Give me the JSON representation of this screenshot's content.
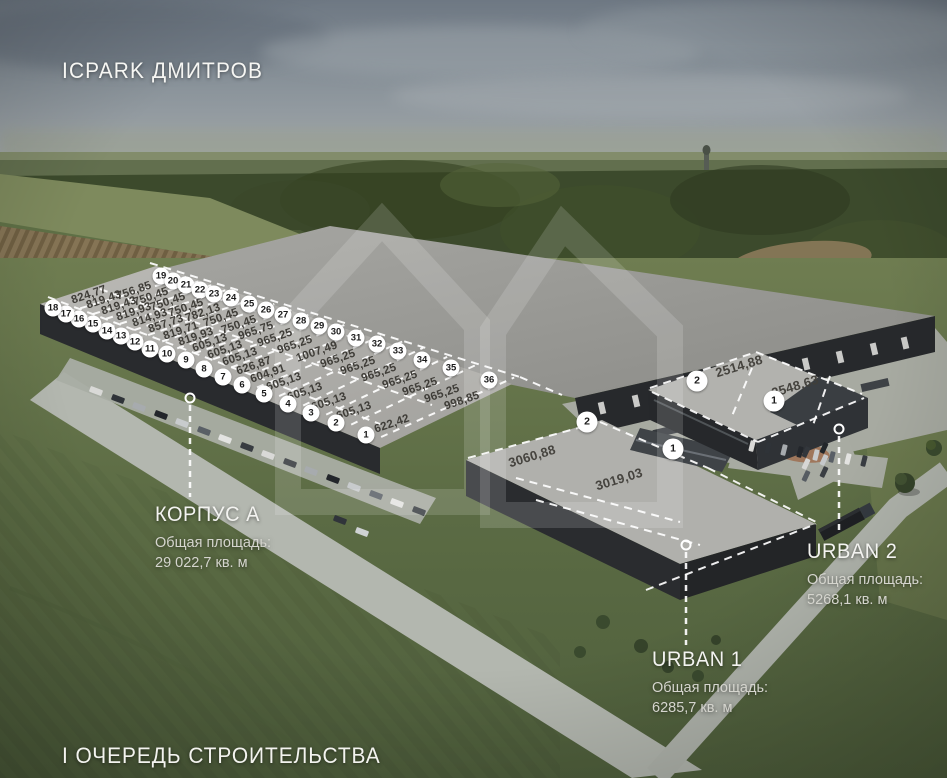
{
  "title": "ICPARK ДМИТРОВ",
  "phase": "I ОЧЕРЕДЬ СТРОИТЕЛЬСТВА",
  "blocks": {
    "korpus_a": {
      "name": "КОРПУС А",
      "area_caption": "Общая площадь:",
      "area_value": "29 022,7 кв. м"
    },
    "urban_1": {
      "name": "URBAN 1",
      "area_caption": "Общая площадь:",
      "area_value": "6285,7 кв. м"
    },
    "urban_2": {
      "name": "URBAN 2",
      "area_caption": "Общая площадь:",
      "area_value": "5268,1 кв. м"
    }
  },
  "korpus_a_units": [
    {
      "n": 1,
      "mx": 366,
      "my": 435,
      "lx": 392,
      "ly": 424,
      "area": "622,42"
    },
    {
      "n": 2,
      "mx": 336,
      "my": 423,
      "lx": 354,
      "ly": 411,
      "area": "605,13"
    },
    {
      "n": 3,
      "mx": 311,
      "my": 413,
      "lx": 329,
      "ly": 402,
      "area": "605,13"
    },
    {
      "n": 4,
      "mx": 288,
      "my": 404,
      "lx": 305,
      "ly": 392,
      "area": "605,13"
    },
    {
      "n": 5,
      "mx": 264,
      "my": 394,
      "lx": 284,
      "ly": 382,
      "area": "605,13"
    },
    {
      "n": 6,
      "mx": 242,
      "my": 385,
      "lx": 268,
      "ly": 374,
      "area": "604,91"
    },
    {
      "n": 7,
      "mx": 223,
      "my": 377,
      "lx": 254,
      "ly": 366,
      "area": "626,87"
    },
    {
      "n": 8,
      "mx": 204,
      "my": 369,
      "lx": 240,
      "ly": 357,
      "area": "605,13"
    },
    {
      "n": 9,
      "mx": 186,
      "my": 360,
      "lx": 225,
      "ly": 350,
      "area": "605,13"
    },
    {
      "n": 10,
      "mx": 167,
      "my": 354,
      "lx": 210,
      "ly": 343,
      "area": "605,13"
    },
    {
      "n": 11,
      "mx": 150,
      "my": 349,
      "lx": 196,
      "ly": 337,
      "area": "819,93"
    },
    {
      "n": 12,
      "mx": 135,
      "my": 342,
      "lx": 181,
      "ly": 331,
      "area": "819,71"
    },
    {
      "n": 13,
      "mx": 121,
      "my": 336,
      "lx": 166,
      "ly": 324,
      "area": "857,73"
    },
    {
      "n": 14,
      "mx": 107,
      "my": 331,
      "lx": 150,
      "ly": 318,
      "area": "814,93"
    },
    {
      "n": 15,
      "mx": 93,
      "my": 324,
      "lx": 134,
      "ly": 312,
      "area": "819,93"
    },
    {
      "n": 16,
      "mx": 79,
      "my": 319,
      "lx": 119,
      "ly": 306,
      "area": "819,43"
    },
    {
      "n": 17,
      "mx": 66,
      "my": 314,
      "lx": 104,
      "ly": 300,
      "area": "819,43"
    },
    {
      "n": 18,
      "mx": 53,
      "my": 308,
      "lx": 89,
      "ly": 295,
      "area": "824,77"
    },
    {
      "n": 19,
      "mx": 161,
      "my": 276,
      "lx": 134,
      "ly": 291,
      "area": "756,85"
    },
    {
      "n": 20,
      "mx": 173,
      "my": 281,
      "lx": 151,
      "ly": 297,
      "area": "750,45"
    },
    {
      "n": 21,
      "mx": 186,
      "my": 285,
      "lx": 168,
      "ly": 302,
      "area": "750,45"
    },
    {
      "n": 22,
      "mx": 200,
      "my": 290,
      "lx": 186,
      "ly": 308,
      "area": "750,45"
    },
    {
      "n": 23,
      "mx": 214,
      "my": 294,
      "lx": 203,
      "ly": 313,
      "area": "782,13"
    },
    {
      "n": 24,
      "mx": 231,
      "my": 298,
      "lx": 221,
      "ly": 318,
      "area": "750,45"
    },
    {
      "n": 25,
      "mx": 249,
      "my": 304,
      "lx": 239,
      "ly": 325,
      "area": "750,45"
    },
    {
      "n": 26,
      "mx": 266,
      "my": 310,
      "lx": 256,
      "ly": 331,
      "area": "965,75"
    },
    {
      "n": 27,
      "mx": 283,
      "my": 315,
      "lx": 275,
      "ly": 338,
      "area": "965,25"
    },
    {
      "n": 28,
      "mx": 301,
      "my": 321,
      "lx": 295,
      "ly": 345,
      "area": "965,25"
    },
    {
      "n": 29,
      "mx": 319,
      "my": 326,
      "lx": 317,
      "ly": 352,
      "area": "1007,49"
    },
    {
      "n": 30,
      "mx": 336,
      "my": 332,
      "lx": 338,
      "ly": 359,
      "area": "965,25"
    },
    {
      "n": 31,
      "mx": 356,
      "my": 338,
      "lx": 358,
      "ly": 366,
      "area": "965,25"
    },
    {
      "n": 32,
      "mx": 377,
      "my": 344,
      "lx": 379,
      "ly": 373,
      "area": "965,25"
    },
    {
      "n": 33,
      "mx": 398,
      "my": 351,
      "lx": 400,
      "ly": 380,
      "area": "965,25"
    },
    {
      "n": 34,
      "mx": 422,
      "my": 360,
      "lx": 420,
      "ly": 387,
      "area": "965,25"
    },
    {
      "n": 35,
      "mx": 451,
      "my": 368,
      "lx": 442,
      "ly": 394,
      "area": "965,25"
    },
    {
      "n": 36,
      "mx": 489,
      "my": 380,
      "lx": 462,
      "ly": 401,
      "area": "998,85"
    }
  ],
  "urban_1_units": [
    {
      "n": 2,
      "mx": 587,
      "my": 422,
      "lx": 532,
      "ly": 456,
      "area": "3060,88"
    },
    {
      "n": 1,
      "mx": 673,
      "my": 449,
      "lx": 619,
      "ly": 479,
      "area": "3019,03"
    }
  ],
  "urban_2_units": [
    {
      "n": 2,
      "mx": 697,
      "my": 381,
      "lx": 739,
      "ly": 366,
      "area": "2514,88"
    },
    {
      "n": 1,
      "mx": 774,
      "my": 401,
      "lx": 795,
      "ly": 386,
      "area": "2548,63"
    }
  ],
  "dash_lines": [
    {
      "x1": 48,
      "y1": 297,
      "x2": 380,
      "y2": 424
    },
    {
      "x1": 150,
      "y1": 263,
      "x2": 520,
      "y2": 377
    },
    {
      "x1": 520,
      "y1": 377,
      "x2": 562,
      "y2": 395
    },
    {
      "x1": 100,
      "y1": 289,
      "x2": 432,
      "y2": 405
    },
    {
      "x1": 468,
      "y1": 458,
      "x2": 600,
      "y2": 422
    },
    {
      "x1": 600,
      "y1": 422,
      "x2": 708,
      "y2": 468
    },
    {
      "x1": 708,
      "y1": 468,
      "x2": 816,
      "y2": 522
    },
    {
      "x1": 516,
      "y1": 478,
      "x2": 680,
      "y2": 522
    },
    {
      "x1": 536,
      "y1": 500,
      "x2": 700,
      "y2": 545
    },
    {
      "x1": 646,
      "y1": 590,
      "x2": 816,
      "y2": 524
    },
    {
      "x1": 650,
      "y1": 388,
      "x2": 756,
      "y2": 352
    },
    {
      "x1": 756,
      "y1": 352,
      "x2": 862,
      "y2": 394
    },
    {
      "x1": 752,
      "y1": 368,
      "x2": 732,
      "y2": 416
    },
    {
      "x1": 830,
      "y1": 376,
      "x2": 812,
      "y2": 428
    },
    {
      "x1": 652,
      "y1": 392,
      "x2": 758,
      "y2": 442
    },
    {
      "x1": 758,
      "y1": 442,
      "x2": 864,
      "y2": 398
    }
  ],
  "leaders": [
    {
      "x": 190,
      "ry": 398,
      "y1": 405,
      "y2": 497
    },
    {
      "x": 686,
      "ry": 545,
      "y1": 552,
      "y2": 645
    },
    {
      "x": 839,
      "ry": 429,
      "y1": 436,
      "y2": 530
    }
  ],
  "colors": {
    "dash": "#ffffff",
    "marker_bg": "#ffffff",
    "marker_text": "#1a1a1a",
    "area_text": "#3a3833",
    "watermark": "rgba(255,255,255,0.15)"
  }
}
